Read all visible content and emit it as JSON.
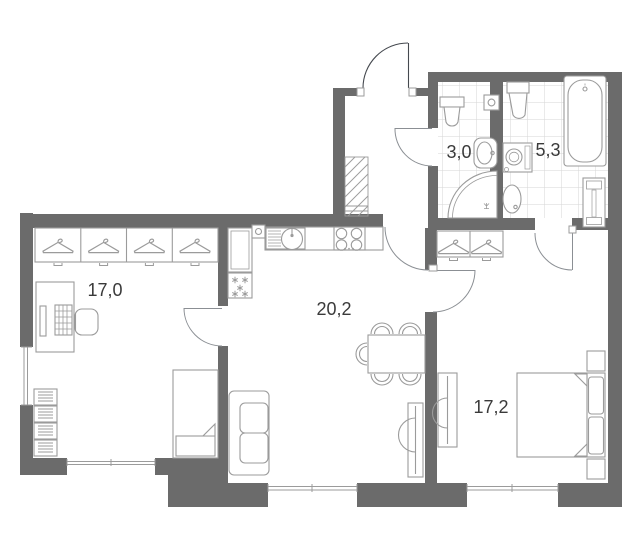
{
  "plan": {
    "title": "Apartment floor plan",
    "rooms": [
      {
        "id": "room-left",
        "name": "room",
        "area_label": "17,0"
      },
      {
        "id": "kitchen-living",
        "name": "kitchen-living",
        "area_label": "20,2"
      },
      {
        "id": "bathroom-small",
        "name": "bathroom",
        "area_label": "3,0"
      },
      {
        "id": "bathroom-large",
        "name": "bathroom",
        "area_label": "5,3"
      },
      {
        "id": "bedroom",
        "name": "bedroom",
        "area_label": "17,2"
      }
    ],
    "colors": {
      "background": "#ffffff",
      "wall": "#6b6b6b",
      "furniture_line": "#9b9b9b",
      "tile_line": "#d6d6d6",
      "door_arc": "#8b8f94",
      "entrance_arc": "#45494f",
      "label_text": "#3a3a3a"
    }
  }
}
